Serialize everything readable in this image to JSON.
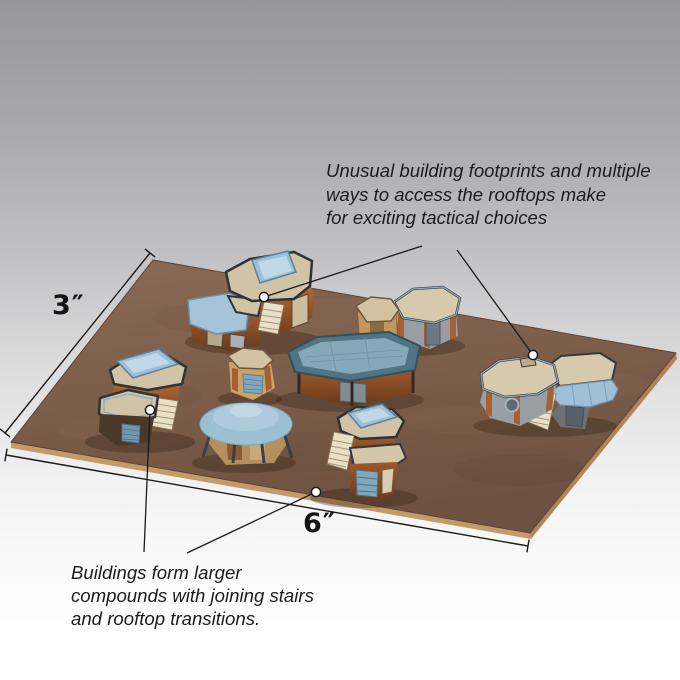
{
  "annotations": {
    "tactical": {
      "lines": [
        "Unusual building footprints and multiple",
        "ways to access the rooftops make",
        "for exciting tactical choices"
      ]
    },
    "compounds": {
      "lines": [
        "Buildings form larger",
        "compounds with joining stairs",
        "and rooftop transitions."
      ]
    }
  },
  "dimensions": {
    "depth_label": "3″",
    "width_label": "6″"
  },
  "scene": {
    "colors": {
      "background_top": "#97979a",
      "background_bottom": "#ffffff",
      "mat_brown": "#7c5c48",
      "mat_edge_tan": "#c59a6b",
      "roof_tan": "#d5c8ab",
      "roof_blue": "#9fc0d6",
      "skylight_blue": "#9dc0d8",
      "wall_rust": "#a05a2c",
      "wall_gray": "#989ea3",
      "trim_dark": "#34383d",
      "annotation_line": "#1b1b1b",
      "marker_fill": "#ffffff"
    },
    "buildings": [
      "north-compound-skylight-and-stairs",
      "center-octagon-pair",
      "central-hall-flat-blue-roof",
      "small-tan-tower",
      "domed-cantina",
      "west-compound-skylight",
      "east-compound-octagon-barrel-roof",
      "south-compound-skylight-and-stairs"
    ]
  }
}
